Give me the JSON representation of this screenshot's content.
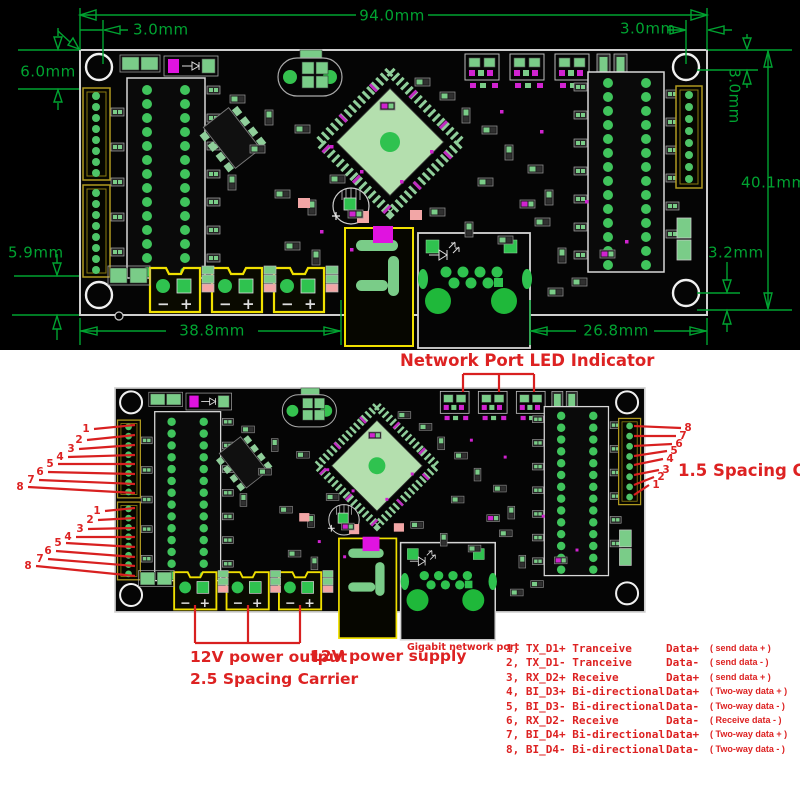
{
  "top_view": {
    "dimensions": {
      "board_width": "94.0mm",
      "hole_offset_top_left": "3.0mm",
      "edge_clearance_left": "6.0mm",
      "hole_offset_top_right": "3.0mm",
      "hole_offset_right_vertical": "3.0mm",
      "board_height": "40.1mm",
      "edge_clearance_bottom_left": "5.9mm",
      "hole_offset_bottom_right": "3.2mm",
      "segment_width_left": "38.8mm",
      "segment_width_right": "26.8mm"
    },
    "silkscreen": {
      "minus": "−",
      "plus": "+"
    }
  },
  "bottom_view": {
    "annotations": {
      "led_indicator": "Network Port LED Indicator",
      "carrier_right": "1.5 Spacing Carrier",
      "power_output": "12V power output",
      "carrier_bottom": "2.5 Spacing Carrier",
      "power_supply": "12V power supply",
      "network_port": "Gigabit network port"
    },
    "pin_numbers_left_group1": [
      "1",
      "2",
      "3",
      "4",
      "5",
      "6",
      "7",
      "8"
    ],
    "pin_numbers_left_group2": [
      "1",
      "2",
      "3",
      "4",
      "5",
      "6",
      "7",
      "8"
    ],
    "pin_numbers_right": [
      "8",
      "7",
      "6",
      "5",
      "4",
      "3",
      "2",
      "1"
    ],
    "pin_table": [
      {
        "pin": "1, TX_D1+ Tranceive",
        "data": "Data+",
        "note": "(  send data +  )"
      },
      {
        "pin": "2, TX_D1- Tranceive",
        "data": "Data-",
        "note": "(  send data -  )"
      },
      {
        "pin": "3, RX_D2+ Receive",
        "data": "Data+",
        "note": "(  send data +  )"
      },
      {
        "pin": "4, BI_D3+ Bi-directional",
        "data": "Data+",
        "note": "( Two-way data + )"
      },
      {
        "pin": "5, BI_D3- Bi-directional",
        "data": "Data-",
        "note": "( Two-way data - )"
      },
      {
        "pin": "6, RX_D2- Receive",
        "data": "Data-",
        "note": "( Receive data - )"
      },
      {
        "pin": "7, BI_D4+ Bi-directional",
        "data": "Data+",
        "note": "( Two-way data + )"
      },
      {
        "pin": "8, BI_D4- Bi-directional",
        "data": "Data-",
        "note": "( Two-way data - )"
      }
    ]
  },
  "colors": {
    "dimension_green": "#00a331",
    "annotation_red": "#dd2222",
    "pad_green": "#2fc24f",
    "silk_magenta": "#d023d0",
    "connector_yellow": "#f0e000",
    "board_black": "#050505"
  }
}
